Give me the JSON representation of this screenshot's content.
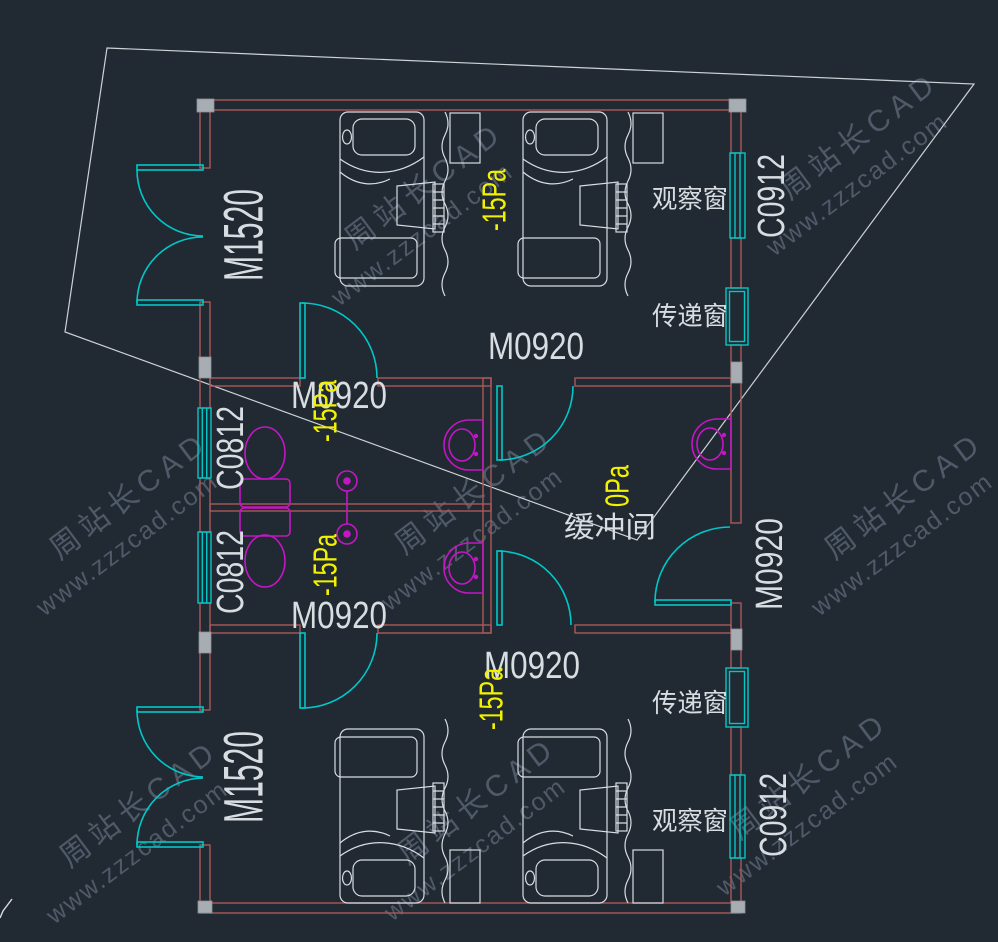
{
  "drawing_type": "cad-floor-plan",
  "colors": {
    "background": "#212933",
    "wall": "#ab5858",
    "door_window": "#00c8c8",
    "fixture": "#c516c5",
    "furniture_line": "#d8dde2",
    "label_text": "#d8dde2",
    "pressure_text": "#f2f200",
    "column_fill": "#a7adb3",
    "site_boundary": "#cdd2d7",
    "watermark": "#7d8c9e"
  },
  "watermark": {
    "brand": "周站长CAD",
    "site": "www.zzzcad.com"
  },
  "rooms": {
    "ward_top": {
      "entry_door": "M1520",
      "pressure": "-15Pa",
      "inner_door": "M0920",
      "observation_window_label": "观察窗",
      "observation_window_code": "C0912",
      "transfer_window_label": "传递窗"
    },
    "bath_upper": {
      "door": "M0920",
      "pressure": "-15Pa",
      "window_code": "C0812"
    },
    "bath_lower": {
      "door": "M0920",
      "pressure": "-15Pa",
      "window_code": "C0812"
    },
    "buffer": {
      "name": "缓冲间",
      "pressure": "0Pa",
      "exit_door": "M0920"
    },
    "ward_bottom": {
      "entry_door": "M1520",
      "pressure": "-15Pa",
      "inner_door": "M0920",
      "observation_window_label": "观察窗",
      "observation_window_code": "C0912",
      "transfer_window_label": "传递窗"
    }
  }
}
